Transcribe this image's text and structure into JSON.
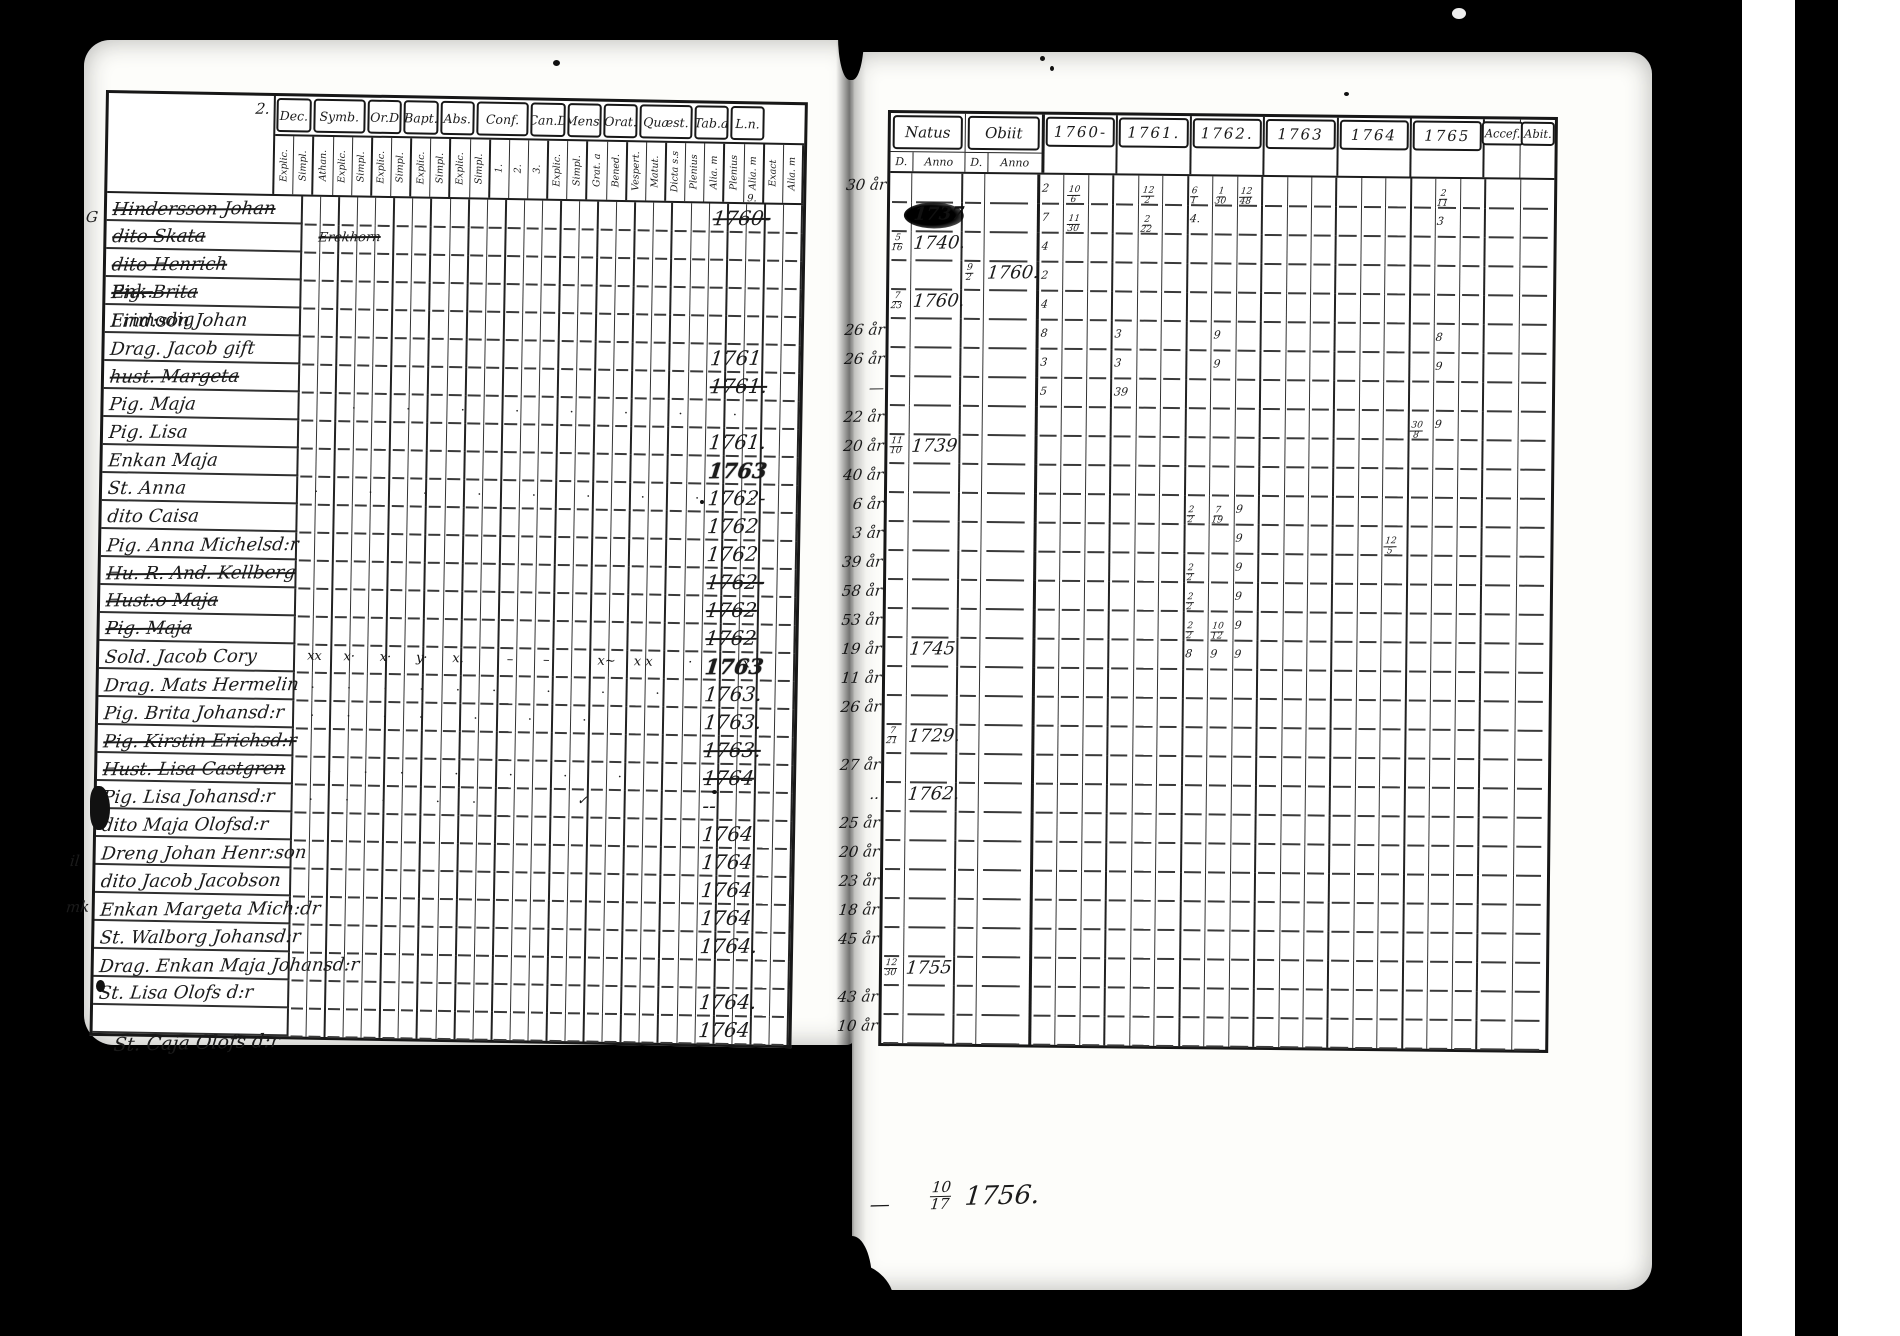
{
  "left_page": {
    "corner_mark": "2.",
    "below_table_name": "St. Caja Olofs d:r",
    "margin_notes": [
      {
        "text": "G",
        "left": 2,
        "top": 168
      },
      {
        "text": "il",
        "left": -14,
        "top": 812
      },
      {
        "text": "mk",
        "left": -18,
        "top": 858
      }
    ],
    "columns": [
      {
        "label": "Dec.",
        "subs": [
          "Explic.",
          "Simpl."
        ]
      },
      {
        "label": "Symb.",
        "subs": [
          "Athan.",
          "Explic.",
          "Simpl."
        ]
      },
      {
        "label": "Or.D",
        "subs": [
          "Explic.",
          "Simpl."
        ]
      },
      {
        "label": "Bapt.",
        "subs": [
          "Explic.",
          "Simpl."
        ]
      },
      {
        "label": "Abs.",
        "subs": [
          "Explic.",
          "Simpl."
        ]
      },
      {
        "label": "Conf.",
        "subs": [
          "1.",
          "2.",
          "3."
        ]
      },
      {
        "label": "Can.D",
        "subs": [
          "Explic.",
          "Simpl."
        ]
      },
      {
        "label": "Mens.",
        "subs": [
          "Grat. a",
          "Bened."
        ]
      },
      {
        "label": "Orat.",
        "subs": [
          "Vespert.",
          "Matut."
        ]
      },
      {
        "label": "Quæst.",
        "subs": [
          "Dicta s.s",
          "Plenius",
          "Alia. m"
        ]
      },
      {
        "label": "Tab.a",
        "subs": [
          "Plenius",
          "Alia. m"
        ]
      },
      {
        "label": "L.n.",
        "subs": [
          "Exact",
          "Alia. m"
        ]
      }
    ],
    "rows": [
      {
        "name": "Hindersson Johan",
        "crossed": true,
        "ln": "1760-",
        "ln_sup": "9."
      },
      {
        "name": "dito Skata",
        "crossed": true,
        "strike_note": "Erekhorn"
      },
      {
        "name": "dito Henrich",
        "crossed": true
      },
      {
        "name": "Pig. Brita",
        "crossed": true,
        "sup": "Enk."
      },
      {
        "name": "Lind:son Johan",
        "crossed": false,
        "sup": "Frimodig"
      },
      {
        "name": "Drag. Jacob gift",
        "crossed": false,
        "ln": "1761"
      },
      {
        "name": "hust. Margeta",
        "crossed": true,
        "ln": "1761."
      },
      {
        "name": "Pig. Maja",
        "crossed": false,
        "dots": [
          2,
          5,
          8,
          11,
          14,
          17,
          20,
          23
        ]
      },
      {
        "name": "Pig. Lisa",
        "crossed": false,
        "ln": "1761."
      },
      {
        "name": "Enkan Maja",
        "crossed": false,
        "ln": "1763",
        "ln_bold": true
      },
      {
        "name": "St. Anna",
        "crossed": false,
        "ln": "1762-",
        "dots": [
          0,
          3,
          6,
          9,
          12,
          15,
          18,
          21,
          24
        ]
      },
      {
        "name": "dito Caisa",
        "crossed": false,
        "ln": "1762"
      },
      {
        "name": "Pig. Anna Michelsd:r",
        "crossed": false,
        "ln": "1762"
      },
      {
        "name": "Hu. R. And. Kellberg",
        "crossed": true,
        "ln": "1762-"
      },
      {
        "name": "Hust:o Maja",
        "crossed": true,
        "ln": "1762"
      },
      {
        "name": "Pig. Maja",
        "crossed": true,
        "ln": "1762"
      },
      {
        "name": "Sold. Jacob Cory",
        "crossed": false,
        "ln": "1763",
        "ln_bold": true,
        "xmarks": [
          [
            0,
            "xx"
          ],
          [
            2,
            "x·"
          ],
          [
            4,
            "x·"
          ],
          [
            6,
            "y·"
          ],
          [
            8,
            "x."
          ],
          [
            11,
            "–"
          ],
          [
            13,
            "–"
          ],
          [
            16,
            "x~"
          ],
          [
            18,
            "x x"
          ],
          [
            21,
            "·"
          ],
          [
            24,
            "x"
          ]
        ]
      },
      {
        "name": "Drag. Mats Hermelin",
        "crossed": false,
        "ln": "1763.",
        "dots": [
          0,
          2,
          4,
          6,
          8,
          10,
          13,
          16,
          19
        ]
      },
      {
        "name": "Pig. Brita Johansd:r",
        "crossed": false,
        "ln": "1763.",
        "dots": [
          0,
          2,
          4,
          6,
          9,
          12,
          15
        ]
      },
      {
        "name": "Pig. Kirstin Erichsd:r",
        "crossed": true,
        "ln": "1763."
      },
      {
        "name": "Hust. Lisa Castgren",
        "crossed": true,
        "ln": "1764",
        "dots": [
          1,
          3,
          5,
          8,
          11,
          14,
          17
        ]
      },
      {
        "name": "Pig. Lisa Johansd:r",
        "crossed": false,
        "ln": "--",
        "dots": [
          0,
          2,
          4,
          7,
          9
        ],
        "xmarks": [
          [
            15,
            "✓"
          ]
        ]
      },
      {
        "name": "dito Maja Olofsd:r",
        "crossed": false,
        "ln": "1764"
      },
      {
        "name": "Dreng Johan Henr:son",
        "crossed": false,
        "ln": "1764"
      },
      {
        "name": "dito Jacob Jacobson",
        "crossed": false,
        "ln": "1764"
      },
      {
        "name": "Enkan Margeta Mich:dr",
        "crossed": false,
        "ln": "1764"
      },
      {
        "name": "St. Walborg Johansd:r",
        "crossed": false,
        "ln": "1764."
      },
      {
        "name": "Drag. Enkan Maja Johansd:r",
        "crossed": false,
        "ln": ""
      },
      {
        "name": "St. Lisa Olofs d:r",
        "crossed": false,
        "ln": "1764."
      },
      {
        "name": "",
        "crossed": false,
        "ln": "1764"
      }
    ]
  },
  "right_page": {
    "headers": {
      "natus": "Natus",
      "obiit": "Obiit",
      "natus_d": "D.",
      "natus_anno": "Anno",
      "obiit_d": "D.",
      "obiit_anno": "Anno",
      "years": [
        "1760-",
        "1761.",
        "1762.",
        "1763",
        "1764",
        "1765"
      ],
      "acces": "Accef.",
      "abit": "Abit."
    },
    "rows": [
      {
        "age": "30 år",
        "marks": [
          [
            0,
            0,
            "2"
          ],
          [
            0,
            1,
            "10/6"
          ],
          [
            1,
            1,
            "12/2"
          ],
          [
            2,
            0,
            "6/1"
          ],
          [
            2,
            1,
            "1/30"
          ],
          [
            2,
            2,
            "12/48"
          ],
          [
            5,
            1,
            "2/11"
          ]
        ]
      },
      {
        "age": "",
        "natus_a": "1737",
        "blot": true,
        "marks": [
          [
            0,
            0,
            "7"
          ],
          [
            0,
            1,
            "11/30"
          ],
          [
            1,
            1,
            "2/22"
          ],
          [
            2,
            0,
            "4."
          ],
          [
            5,
            1,
            "3"
          ]
        ]
      },
      {
        "age": "",
        "natus_d": "5/16",
        "natus_a": "1740.",
        "marks": [
          [
            0,
            0,
            "4"
          ]
        ]
      },
      {
        "age": "",
        "obiit_d": "9/2",
        "obiit_a": "1760.",
        "marks": [
          [
            0,
            0,
            "2"
          ]
        ]
      },
      {
        "age": "",
        "natus_d": "7/23",
        "natus_a": "1760.",
        "marks": [
          [
            0,
            0,
            "4"
          ]
        ]
      },
      {
        "age": "26 år",
        "marks": [
          [
            0,
            0,
            "8"
          ],
          [
            1,
            0,
            "3"
          ],
          [
            2,
            1,
            "9"
          ],
          [
            5,
            1,
            "8"
          ]
        ]
      },
      {
        "age": "26 år",
        "marks": [
          [
            0,
            0,
            "3"
          ],
          [
            1,
            0,
            "3"
          ],
          [
            2,
            1,
            "9"
          ],
          [
            5,
            1,
            "9"
          ]
        ]
      },
      {
        "age": "—",
        "marks": [
          [
            0,
            0,
            "5"
          ],
          [
            1,
            0,
            "39"
          ]
        ]
      },
      {
        "age": "22 år",
        "marks": [
          [
            5,
            0,
            "30/8"
          ],
          [
            5,
            1,
            "9"
          ]
        ]
      },
      {
        "age": "20 år",
        "natus_d": "11/10",
        "natus_a": "1739"
      },
      {
        "age": "40 år"
      },
      {
        "age": "6 år",
        "marks": [
          [
            2,
            0,
            "2/2"
          ],
          [
            2,
            1,
            "7/19"
          ],
          [
            2,
            2,
            "9"
          ]
        ]
      },
      {
        "age": "3 år",
        "marks": [
          [
            2,
            2,
            "9"
          ],
          [
            4,
            2,
            "12/5"
          ]
        ]
      },
      {
        "age": "39 år",
        "marks": [
          [
            2,
            0,
            "2/2"
          ],
          [
            2,
            2,
            "9"
          ]
        ]
      },
      {
        "age": "58 år",
        "marks": [
          [
            2,
            0,
            "2/2"
          ],
          [
            2,
            2,
            "9"
          ]
        ]
      },
      {
        "age": "53 år",
        "marks": [
          [
            2,
            0,
            "2/2"
          ],
          [
            2,
            1,
            "10/12"
          ],
          [
            2,
            2,
            "9"
          ]
        ]
      },
      {
        "age": "19 år",
        "natus_a": "1745",
        "marks": [
          [
            2,
            0,
            "8"
          ],
          [
            2,
            1,
            "9"
          ],
          [
            2,
            2,
            "9"
          ]
        ]
      },
      {
        "age": "11 år"
      },
      {
        "age": "26 år"
      },
      {
        "age": "",
        "natus_d": "7/21",
        "natus_a": "1729."
      },
      {
        "age": "27 år"
      },
      {
        "age": "..",
        "natus_a": "1762."
      },
      {
        "age": "25 år"
      },
      {
        "age": "20 år"
      },
      {
        "age": "23 år"
      },
      {
        "age": "18 år"
      },
      {
        "age": "45 år"
      },
      {
        "age": "",
        "natus_d": "12/30",
        "natus_a": "1755"
      },
      {
        "age": "43 år"
      },
      {
        "age": "10 år"
      }
    ],
    "bottom_note": {
      "dash": "—",
      "frac": "10/17",
      "year": "1756."
    }
  }
}
